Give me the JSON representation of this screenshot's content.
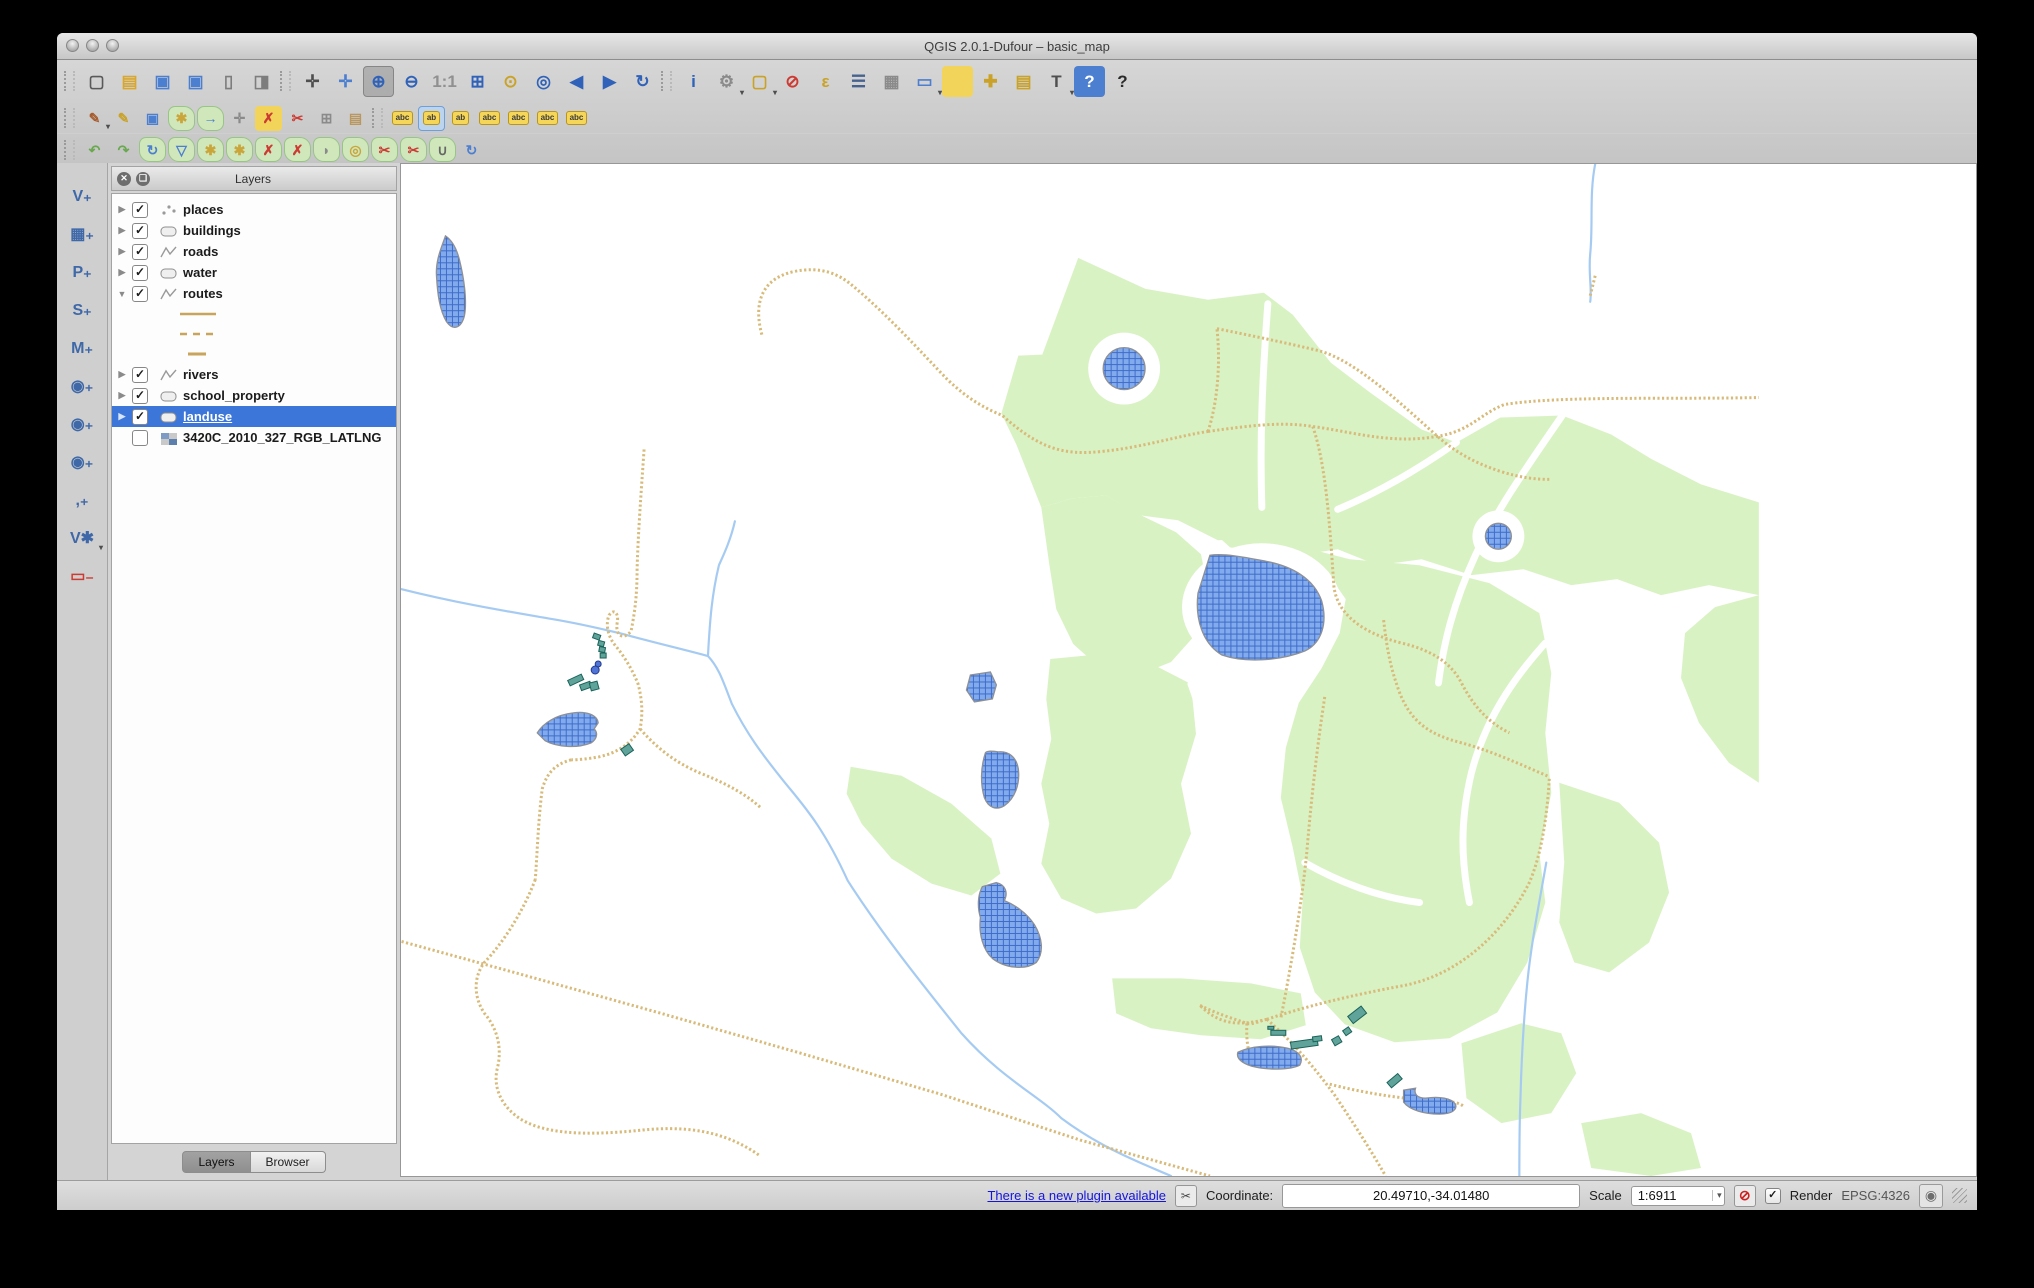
{
  "window": {
    "title": "QGIS 2.0.1-Dufour – basic_map"
  },
  "toolbars": {
    "row1": [
      {
        "n": "new-project",
        "g": "▢",
        "c": "#5a5a5a"
      },
      {
        "n": "open-project",
        "g": "▤",
        "c": "#d9a62e"
      },
      {
        "n": "save-project",
        "g": "▣",
        "c": "#4d7fd0"
      },
      {
        "n": "save-project-as",
        "g": "▣",
        "c": "#4d7fd0"
      },
      {
        "n": "new-print-composer",
        "g": "▯",
        "c": "#7d7d7d"
      },
      {
        "n": "composer-manager",
        "g": "◨",
        "c": "#7d7d7d"
      },
      {
        "sep": true
      },
      {
        "n": "pan-map",
        "g": "✛",
        "c": "#4f4f4f"
      },
      {
        "n": "pan-to-selection",
        "g": "✛",
        "c": "#4d7fd0"
      },
      {
        "n": "zoom-in",
        "g": "⊕",
        "c": "#2f62b8",
        "active": true
      },
      {
        "n": "zoom-out",
        "g": "⊖",
        "c": "#2f62b8"
      },
      {
        "n": "zoom-native",
        "g": "1:1",
        "c": "#909090"
      },
      {
        "n": "zoom-full",
        "g": "⊞",
        "c": "#2f62b8"
      },
      {
        "n": "zoom-to-selection",
        "g": "⊙",
        "c": "#c9a227"
      },
      {
        "n": "zoom-to-layer",
        "g": "◎",
        "c": "#2f62b8"
      },
      {
        "n": "zoom-last",
        "g": "◀",
        "c": "#2f62b8"
      },
      {
        "n": "zoom-next",
        "g": "▶",
        "c": "#2f62b8"
      },
      {
        "n": "refresh-map",
        "g": "↻",
        "c": "#2f62b8"
      },
      {
        "sep": true
      },
      {
        "n": "identify-features",
        "g": "i",
        "c": "#2f62b8"
      },
      {
        "n": "run-feature-action",
        "g": "⚙",
        "c": "#8a8a8a",
        "caret": true
      },
      {
        "n": "select-features",
        "g": "▢",
        "c": "#c9a227",
        "caret": true
      },
      {
        "n": "deselect-features",
        "g": "⊘",
        "c": "#cc3b33"
      },
      {
        "n": "select-by-expression",
        "g": "ε",
        "c": "#c9a227"
      },
      {
        "n": "open-attribute-table",
        "g": "☰",
        "c": "#47628f"
      },
      {
        "n": "field-calculator",
        "g": "▦",
        "c": "#8a8a8a"
      },
      {
        "n": "measure",
        "g": "▭",
        "c": "#4d7fd0",
        "caret": true
      },
      {
        "n": "map-tips",
        "g": "",
        "bg": "#f3d45a"
      },
      {
        "n": "new-bookmark",
        "g": "✚",
        "c": "#c9a227"
      },
      {
        "n": "show-bookmarks",
        "g": "▤",
        "c": "#c9a227"
      },
      {
        "n": "text-annotation",
        "g": "T",
        "c": "#4f4f4f",
        "caret": true
      },
      {
        "n": "help",
        "g": "?",
        "c": "#ffffff",
        "bg": "#4d7fd0"
      },
      {
        "n": "whats-this",
        "g": "?",
        "c": "#2b2b2b"
      }
    ],
    "row2": [
      {
        "n": "current-edits",
        "g": "✎",
        "c": "#a65c2e",
        "caret": true
      },
      {
        "n": "toggle-editing",
        "g": "✎",
        "c": "#c9a227"
      },
      {
        "n": "save-layer-edits",
        "g": "▣",
        "c": "#4d7fd0"
      },
      {
        "n": "add-feature",
        "g": "✱",
        "c": "#caa53a",
        "blob": true
      },
      {
        "n": "move-feature",
        "g": "→",
        "c": "#4d7fd0",
        "blob": true
      },
      {
        "n": "node-tool",
        "g": "✛",
        "c": "#8a8a8a"
      },
      {
        "n": "delete-selected",
        "g": "✗",
        "c": "#cc3b33",
        "bg": "#f3d45a"
      },
      {
        "n": "cut-features",
        "g": "✂",
        "c": "#cc3b33"
      },
      {
        "n": "copy-features",
        "g": "⊞",
        "c": "#8a8a8a"
      },
      {
        "n": "paste-features",
        "g": "▤",
        "c": "#b9975e"
      },
      {
        "sep": true
      },
      {
        "n": "labeling",
        "g": "abc",
        "chip": true
      },
      {
        "n": "label-pin",
        "g": "ab",
        "chip": true,
        "chipsel": true
      },
      {
        "n": "label-unpin",
        "g": "ab",
        "chip": true
      },
      {
        "n": "label-visibility",
        "g": "abc",
        "chip": true
      },
      {
        "n": "label-move",
        "g": "abc",
        "chip": true
      },
      {
        "n": "label-rotate",
        "g": "abc",
        "chip": true
      },
      {
        "n": "label-properties",
        "g": "abc",
        "chip": true
      }
    ],
    "row3": [
      {
        "n": "undo",
        "g": "↶",
        "c": "#6aa84f"
      },
      {
        "n": "redo",
        "g": "↷",
        "c": "#6aa84f"
      },
      {
        "n": "rotate-feature",
        "g": "↻",
        "c": "#4d7fd0",
        "blob": true
      },
      {
        "n": "simplify-feature",
        "g": "▽",
        "c": "#4d7fd0",
        "blob": true
      },
      {
        "n": "add-ring",
        "g": "✱",
        "c": "#caa53a",
        "blob": true
      },
      {
        "n": "add-part",
        "g": "✱",
        "c": "#caa53a",
        "blob": true
      },
      {
        "n": "delete-ring",
        "g": "✗",
        "c": "#cc3b33",
        "blob": true
      },
      {
        "n": "delete-part",
        "g": "✗",
        "c": "#cc3b33",
        "blob": true
      },
      {
        "n": "reshape-features",
        "g": "◗",
        "c": "#8a8a8a",
        "blob": true
      },
      {
        "n": "offset-curve",
        "g": "◎",
        "c": "#caa53a",
        "blob": true
      },
      {
        "n": "split-features",
        "g": "✂",
        "c": "#cc3b33",
        "blob": true
      },
      {
        "n": "split-parts",
        "g": "✂",
        "c": "#cc3b33",
        "blob": true
      },
      {
        "n": "merge-features",
        "g": "∪",
        "c": "#666666",
        "blob": true
      },
      {
        "n": "rotate-point-symbols",
        "g": "↻",
        "c": "#4d7fd0"
      }
    ],
    "side": [
      {
        "n": "add-vector-layer",
        "g": "V₊",
        "c": "#3f68a8"
      },
      {
        "n": "add-raster-layer",
        "g": "▦₊",
        "c": "#3f68a8"
      },
      {
        "n": "add-postgis-layer",
        "g": "P₊",
        "c": "#3f68a8"
      },
      {
        "n": "add-spatialite-layer",
        "g": "S₊",
        "c": "#3f68a8"
      },
      {
        "n": "add-mssql-layer",
        "g": "M₊",
        "c": "#3f68a8"
      },
      {
        "n": "add-wms-layer",
        "g": "◉₊",
        "c": "#3f68a8"
      },
      {
        "n": "add-wcs-layer",
        "g": "◉₊",
        "c": "#3f68a8"
      },
      {
        "n": "add-wfs-layer",
        "g": "◉₊",
        "c": "#3f68a8"
      },
      {
        "n": "add-delimited-text-layer",
        "g": ",₊",
        "c": "#3f68a8"
      },
      {
        "n": "new-shapefile-layer",
        "g": "V✱",
        "c": "#3f68a8",
        "caret": true
      },
      {
        "n": "remove-layer",
        "g": "▭₋",
        "c": "#cc3b33"
      }
    ]
  },
  "layers_panel": {
    "title": "Layers",
    "tabs": [
      {
        "label": "Layers",
        "active": true
      },
      {
        "label": "Browser",
        "active": false
      }
    ],
    "items": [
      {
        "label": "places",
        "type": "point",
        "checked": true,
        "expanded": false
      },
      {
        "label": "buildings",
        "type": "polygon",
        "checked": true,
        "expanded": false
      },
      {
        "label": "roads",
        "type": "line",
        "checked": true,
        "expanded": false
      },
      {
        "label": "water",
        "type": "polygon",
        "checked": true,
        "expanded": false
      },
      {
        "label": "routes",
        "type": "line",
        "checked": true,
        "expanded": true,
        "children": [
          {
            "swatch": "solid"
          },
          {
            "swatch": "dashed"
          },
          {
            "swatch": "short"
          }
        ]
      },
      {
        "label": "rivers",
        "type": "line",
        "checked": true,
        "expanded": false
      },
      {
        "label": "school_property",
        "type": "polygon",
        "checked": true,
        "expanded": false
      },
      {
        "label": "landuse",
        "type": "polygon",
        "checked": true,
        "expanded": false,
        "selected": true
      },
      {
        "label": "3420C_2010_327_RGB_LATLNG",
        "type": "raster",
        "checked": false,
        "expanded": false
      }
    ]
  },
  "status_bar": {
    "plugin_link": "There is a new plugin available",
    "coordinate_label": "Coordinate:",
    "coordinate_value": "20.49710,-34.01480",
    "scale_label": "Scale",
    "scale_value": "1:6911",
    "render_label": "Render",
    "render_checked": "✓",
    "crs_label": "EPSG:4326"
  },
  "map": {
    "colors": {
      "landuse_green": "#d9f2c3",
      "lake_fill": "#82abee",
      "lake_grid": "#3f6cc9",
      "lake_stroke": "#8e9094",
      "road_tan": "#d8bb7b",
      "river_blue": "#a6cbf2",
      "building_fill": "#60a39a",
      "building_stroke": "#19635a",
      "point_blue": "#4f74d6"
    },
    "greens": [
      "M678,94 L745,125 L808,136 L864,129 L893,151 L931,199 L969,228 L1022,266 L1057,279 L1101,254 L1163,252 L1212,271 L1253,296 L1302,321 L1360,339 L1360,432 L1310,422 L1262,432 L1218,416 L1172,422 L1124,406 L1072,412 L1022,396 L978,402 L938,386 L898,392 L858,374 L818,377 L778,357 L740,352 L706,332 L672,335 L641,344 L616,281 L601,250 L618,192 L642,191 Z",
      "M641,344 L672,335 L706,332 L741,352 L776,369 L801,391 L809,431 L796,471 L771,499 L736,513 L701,506 L673,481 L656,446 L649,401 Z",
      "M806,362 L880,378 L950,396 L1020,402 L1090,420 L1140,450 L1152,510 L1146,570 L1152,630 L1140,690 L1146,740 L1128,800 L1098,850 L1050,876 L995,880 L945,862 L915,830 L900,785 L903,735 L893,685 L881,635 L886,585 L899,540 L922,505 L940,470 L946,436 L928,410 L880,396 L830,384 Z",
      "M650,496 L702,491 L752,501 L791,521 L796,571 L781,621 L791,671 L771,716 L736,746 L696,751 L661,736 L641,701 L649,661 L641,621 L651,576 L646,536 Z",
      "M450,604 L501,613 L551,641 L591,676 L600,711 L571,733 L531,721 L491,696 L461,661 L446,631 Z",
      "M1360,432 L1360,620 L1330,600 L1300,560 L1282,515 L1286,470 L1316,444 Z",
      "M712,816 L781,816 L851,821 L901,831 L906,863 L861,877 L801,873 L751,866 L716,851 Z",
      "M1062,881 L1122,861 L1162,871 L1177,911 L1152,951 L1102,961 L1067,936 Z",
      "M1182,961 L1242,951 L1292,971 L1302,1006 L1252,1014 L1192,1006 Z",
      "M1160,620 L1220,640 L1260,680 L1270,730 L1250,780 L1210,810 L1175,800 L1160,760 L1165,700 Z"
    ],
    "white_gaps": [
      "M868,140 C862,220 860,280 862,344",
      "M1057,279 C1010,312 972,332 938,346",
      "M1163,252 C1130,300 1098,345 1076,392 C1054,440 1044,480 1039,520",
      "M1146,480 C1110,520 1085,560 1072,610 C1060,660 1062,700 1070,740",
      "M791,521 C806,561 812,601 806,651 C800,701 791,731 776,756",
      "M905,700 C940,720 980,735 1020,740",
      "M700,806 C760,806 830,810 900,818"
    ],
    "white_spots": [
      {
        "type": "circle",
        "cx": 724,
        "cy": 205,
        "r": 36
      },
      {
        "type": "circle",
        "cx": 1099,
        "cy": 373,
        "r": 26
      },
      {
        "type": "ellipse",
        "cx": 862,
        "cy": 444,
        "rx": 80,
        "ry": 64
      }
    ],
    "rivers": [
      "M0,426 C60,441 111,449 151,456 C181,461 201,466 222,471 C251,479 281,486 307,493 C319,506 323,521 331,541 C346,571 361,591 381,616 C401,641 421,661 447,718 C481,771 521,821 561,871 C601,916 639,934 661,956 C701,986 741,1001 771,1014",
      "M334,358 C330,376 323,391 318,402 C311,431 309,456 307,493",
      "M1196,0 C1190,30 1194,60 1191,90 C1189,110 1193,125 1191,138",
      "M1147,700 C1140,740 1132,780 1128,820 C1124,860 1122,900 1121,940 C1120,965 1120,990 1120,1014"
    ],
    "roads": [
      "M361,171 C352,138 362,115 392,108 C420,102 438,110 452,122 C488,152 520,188 547,216 C568,236 585,245 602,252 C640,286 664,292 702,288 C742,284 780,272 808,268",
      "M808,268 C817,241 821,202 817,165",
      "M817,165 C852,172 885,179 919,187 C956,197 1000,239 1037,272 C1057,290 1077,300 1101,308 C1120,314 1135,316 1150,316",
      "M808,268 C851,262 881,258 913,263 C951,268 991,281 1037,273 C1071,268 1081,250 1105,241 C1161,232 1271,236 1360,234",
      "M913,263 C926,300 930,360 934,421 C936,450 962,470 1002,480 C1032,487 1052,500 1062,520 C1075,545 1090,560 1110,570",
      "M984,457 C988,492 992,507 999,527 C1011,560 1031,572 1062,580 C1092,588 1122,602 1150,614",
      "M925,534 C918,580 912,630 907,690 C902,740 892,800 881,856",
      "M0,779 L120,812 L260,851 L400,891 L540,932 L680,978 L810,1014",
      "M134,717 C121,751 101,781 83,800 C71,816 73,836 83,851 C96,866 101,886 96,906 C91,926 101,946 121,958 C151,975 201,972 241,968 C281,964 321,967 358,993",
      "M170,597 C155,601 146,609 141,626 C137,656 136,690 134,717",
      "M243,286 C240,330 237,370 236,406 C236,436 233,452 230,468 C222,478 214,472 216,460 C218,450 213,445 208,452 C204,461 207,473 213,481 C223,493 231,506 237,521 C241,536 242,551 239,566 C230,581 216,590 198,594 C187,596 177,597 170,597",
      "M239,566 C259,589 279,602 301,611 C326,621 346,632 361,646",
      "M800,843 C816,851 832,856 847,861 C853,863 861,858 867,857",
      "M867,857 C892,879 913,903 935,933 C951,957 967,981 986,1014",
      "M867,857 C906,844 951,833 1005,823 C1060,812 1105,770 1130,720 C1143,690 1148,650 1150,616",
      "M867,857 C841,863 821,864 800,843",
      "M930,922 C961,930 1001,937 1041,939 C1053,939 1060,941 1064,944",
      "M1196,112 L1191,132",
      "M847,861 C846,881 849,896 856,903"
    ],
    "lakes": [
      "M44,72 C40,84 34,96 35,112 C36,130 38,146 45,158 C52,168 60,164 63,152 C66,136 62,112 58,96 C55,84 50,76 44,72 Z",
      "M810,392 L798,430 C795,455 802,480 822,492 C845,500 880,498 905,488 C922,480 928,460 922,438 C914,415 892,403 866,398 C845,394 825,390 810,392 Z",
      "M570,512 L590,509 L596,522 L592,536 L574,539 L566,527 Z",
      "M585,590 C580,605 580,622 584,635 C588,645 596,648 604,643 C614,636 620,622 618,606 C616,594 608,588 598,589 C590,588 586,588 585,590 Z",
      "M582,724 L596,720 C605,722 608,730 604,738 C614,742 626,750 634,762 C642,775 644,790 636,800 C625,808 605,806 592,796 C583,788 578,772 580,755 C577,745 577,733 582,724 Z",
      "M136,570 C142,560 155,552 172,550 C185,548 196,552 197,560 L193,566 C197,570 196,576 190,580 C175,586 155,584 144,578 Z",
      "M838,890 C850,884 870,882 888,886 C900,889 904,896 900,903 C890,908 868,908 852,904 C842,901 836,896 838,890 Z",
      "M1004,928 L1016,926 C1014,932 1018,936 1026,936 C1040,934 1052,936 1056,942 C1058,948 1052,952 1040,952 C1025,952 1010,948 1004,940 Z"
    ],
    "lake_circles": [
      {
        "cx": 724,
        "cy": 205,
        "r": 21
      },
      {
        "cx": 1099,
        "cy": 373,
        "r": 13
      }
    ],
    "buildings": [
      [
        192,
        471,
        7,
        5,
        20
      ],
      [
        197,
        478,
        6,
        5,
        15
      ],
      [
        198,
        484,
        6,
        5,
        10
      ],
      [
        199,
        490,
        6,
        5,
        0
      ],
      [
        167,
        514,
        15,
        6,
        -25
      ],
      [
        179,
        520,
        11,
        6,
        -20
      ],
      [
        189,
        519,
        8,
        8,
        -15
      ],
      [
        221,
        583,
        10,
        8,
        -35
      ],
      [
        988,
        915,
        14,
        7,
        -40
      ],
      [
        949,
        848,
        17,
        9,
        -38
      ],
      [
        944,
        866,
        7,
        6,
        -35
      ],
      [
        933,
        875,
        8,
        7,
        -30
      ],
      [
        891,
        878,
        27,
        7,
        -8
      ],
      [
        913,
        874,
        9,
        5,
        -8
      ],
      [
        871,
        868,
        15,
        5,
        0
      ],
      [
        868,
        864,
        6,
        3,
        0
      ]
    ],
    "points": [
      [
        197,
        501,
        3
      ],
      [
        194,
        507,
        4
      ]
    ]
  }
}
